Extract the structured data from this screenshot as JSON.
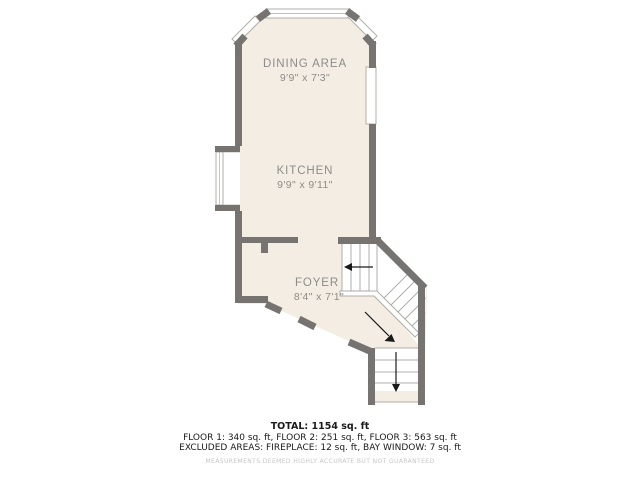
{
  "floorplan": {
    "rooms": [
      {
        "name": "DINING AREA",
        "dims": "9'9\" x 7'3\""
      },
      {
        "name": "KITCHEN",
        "dims": "9'9\" x 9'11\""
      },
      {
        "name": "FOYER",
        "dims": "8'4\" x 7'1\""
      }
    ],
    "colors": {
      "wall": "#767370",
      "floor_fill": "#f3ede4",
      "stair_fill": "#ffffff",
      "thin_line": "#b3afa9",
      "label_text": "#8e8c89",
      "arrow": "#1a1a1a"
    }
  },
  "footer": {
    "total": "TOTAL: 1154 sq. ft",
    "floors": "FLOOR 1: 340 sq. ft, FLOOR 2: 251 sq. ft, FLOOR 3: 563 sq. ft",
    "excluded": "EXCLUDED AREAS: FIREPLACE: 12 sq. ft, BAY WINDOW: 7 sq. ft",
    "disclaimer": "MEASUREMENTS DEEMED HIGHLY ACCURATE BUT NOT GUARANTEED"
  }
}
